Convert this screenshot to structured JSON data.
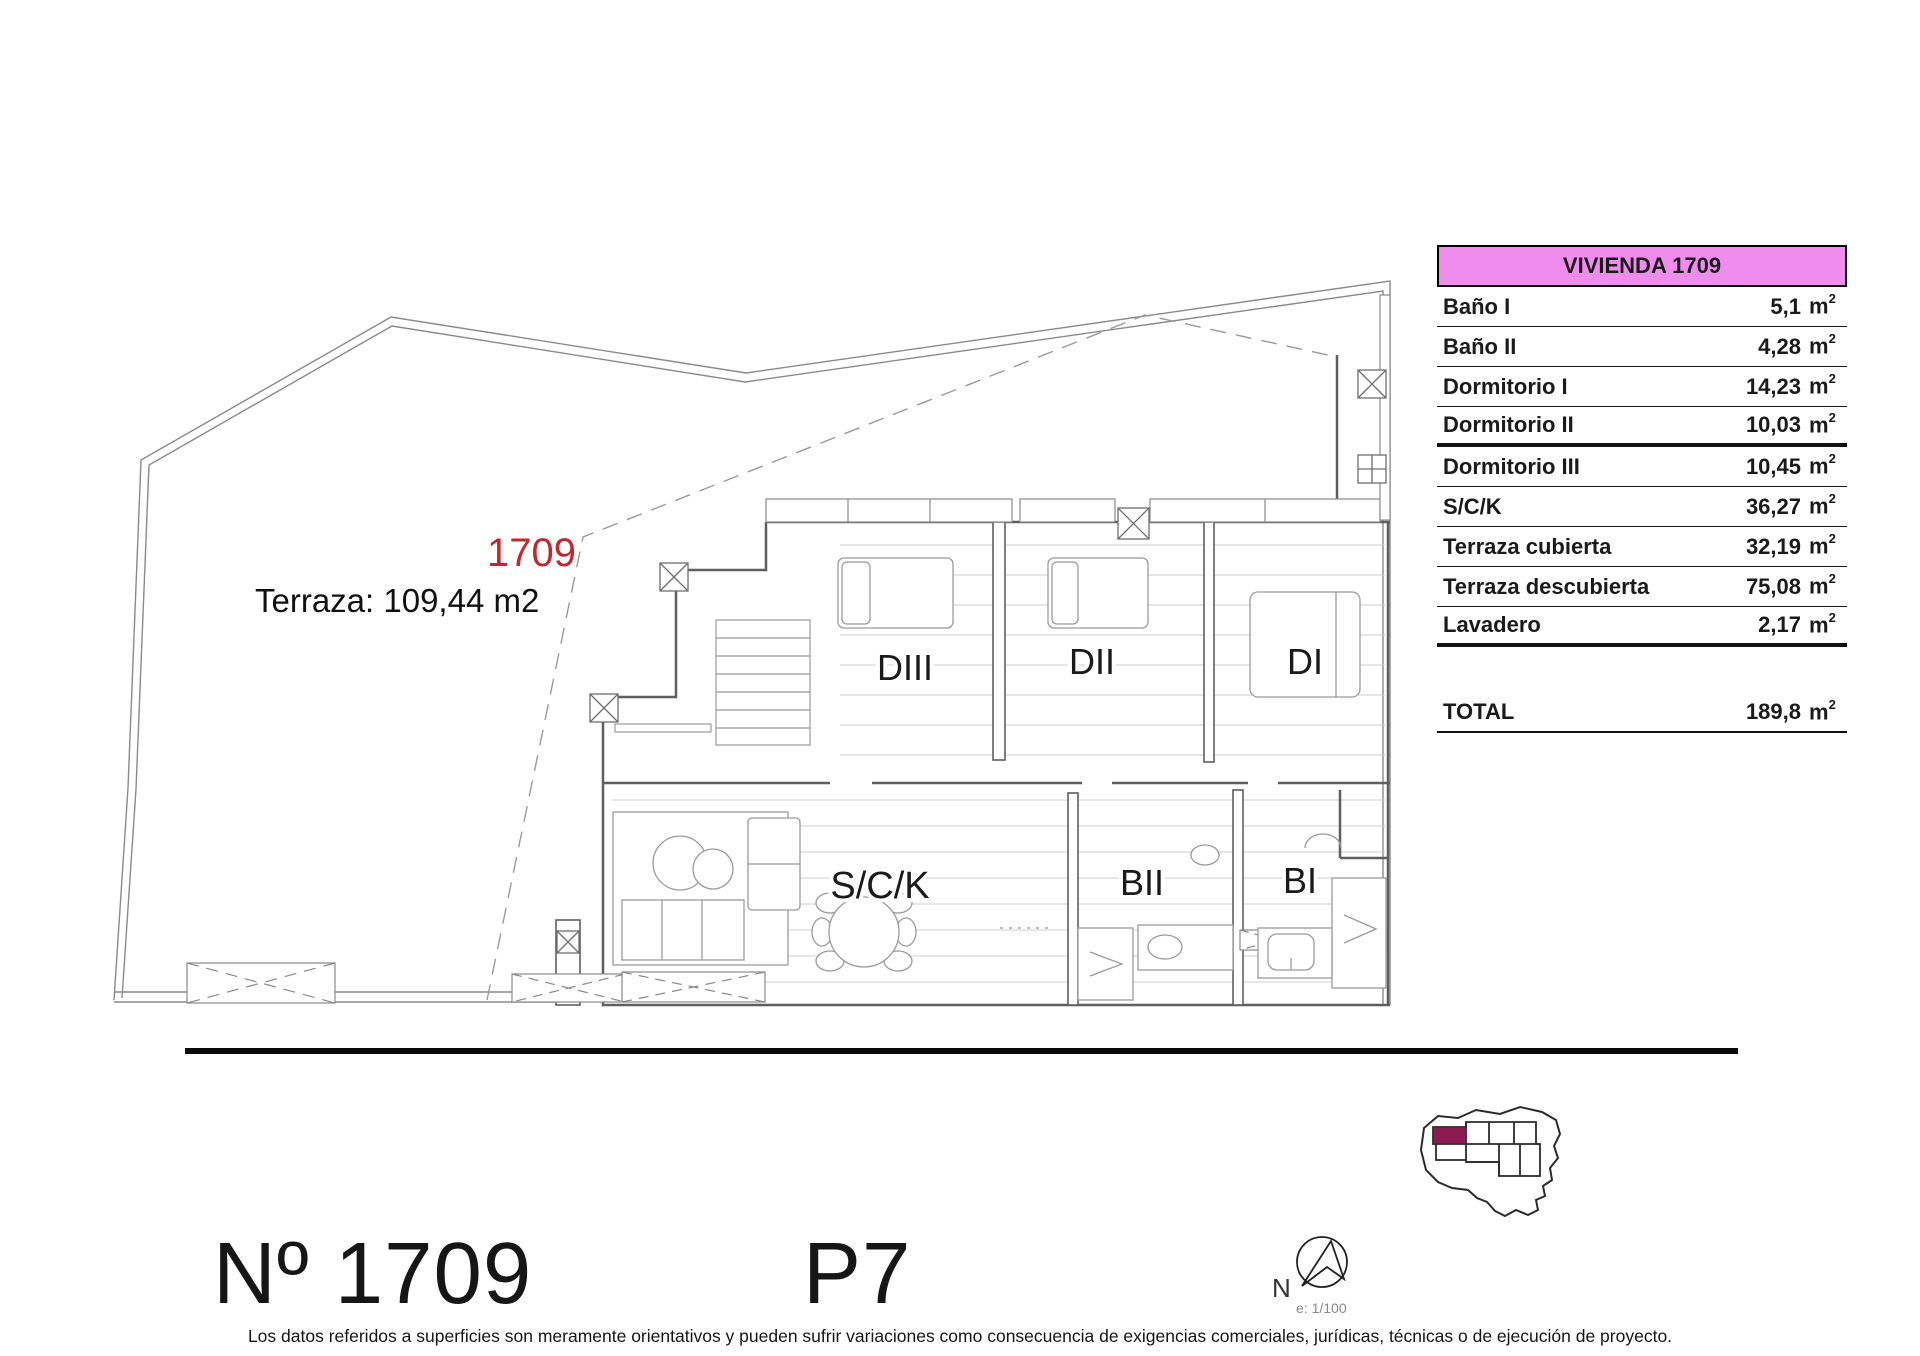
{
  "plan": {
    "unit_label_red": "1709",
    "terrace_label": "Terraza: 109,44 m2",
    "rooms": {
      "diii": "DIII",
      "dii": "DII",
      "di": "DI",
      "sck": "S/C/K",
      "bii": "BII",
      "bi": "BI"
    }
  },
  "table": {
    "header": "VIVIENDA 1709",
    "unit": "m",
    "unit_sup": "2",
    "rows": [
      {
        "label": "Baño I",
        "value": "5,1",
        "sep": "thin"
      },
      {
        "label": "Baño II",
        "value": "4,28",
        "sep": "thin"
      },
      {
        "label": "Dormitorio I",
        "value": "14,23",
        "sep": "thin"
      },
      {
        "label": "Dormitorio II",
        "value": "10,03",
        "sep": "thick"
      },
      {
        "label": "Dormitorio III",
        "value": "10,45",
        "sep": "thin"
      },
      {
        "label": "S/C/K",
        "value": "36,27",
        "sep": "thin"
      },
      {
        "label": "Terraza cubierta",
        "value": "32,19",
        "sep": "thin"
      },
      {
        "label": "Terraza descubierta",
        "value": "75,08",
        "sep": "thin"
      },
      {
        "label": "Lavadero",
        "value": "2,17",
        "sep": "thick"
      }
    ],
    "total_label": "TOTAL",
    "total_value": "189,8"
  },
  "compass": {
    "north_label": "N",
    "scale_label": "e: 1/100"
  },
  "footer": {
    "unit_number": "Nº 1709",
    "floor": "P7",
    "disclaimer": "Los datos referidos a superficies son meramente orientativos y pueden sufrir variaciones como consecuencia de exigencias comerciales, jurídicas, técnicas o de ejecución de proyecto."
  },
  "colors": {
    "accent_pink": "#F18CEF",
    "highlight_maroon": "#8E1A52",
    "red_label": "#C1272D"
  }
}
